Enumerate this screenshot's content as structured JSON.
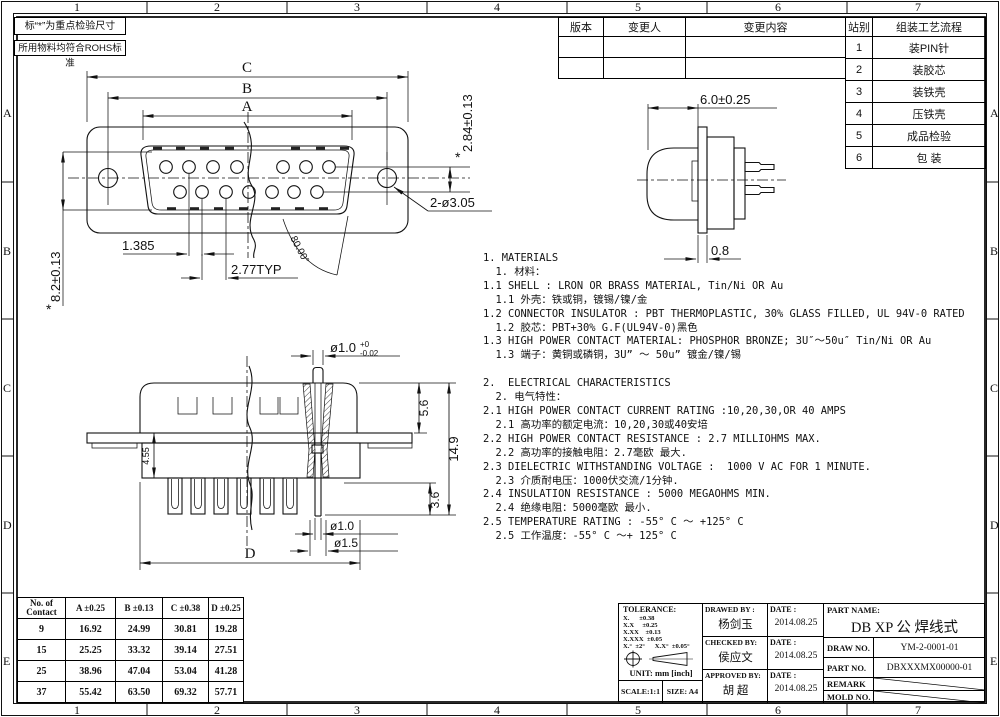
{
  "frame": {
    "cols": [
      "1",
      "2",
      "3",
      "4",
      "5",
      "6",
      "7"
    ],
    "rows": [
      "A",
      "B",
      "C",
      "D",
      "E"
    ]
  },
  "corner_notes": {
    "inspection": "标“*”为重点检验尺寸",
    "rohs": "所用物料均符合ROHS标准"
  },
  "revision_table": {
    "col_version": "版本",
    "col_author": "变更人",
    "col_content": "变更内容"
  },
  "process_table": {
    "col_station": "站别",
    "col_flow": "组装工艺流程",
    "rows": [
      {
        "no": "1",
        "step": "装PIN针"
      },
      {
        "no": "2",
        "step": "装胶芯"
      },
      {
        "no": "3",
        "step": "装铁壳"
      },
      {
        "no": "4",
        "step": "压铁壳"
      },
      {
        "no": "5",
        "step": "成品检验"
      },
      {
        "no": "6",
        "step": "包 装"
      }
    ]
  },
  "front_view": {
    "dim_c": "C",
    "dim_b": "B",
    "dim_a": "A",
    "dim_row": "2.84±0.13",
    "dim_height": "8.2±0.13",
    "star": "*",
    "dim_half_pitch": "1.385",
    "dim_pitch": "2.77TYP",
    "dim_holes": "2-ø3.05",
    "dim_angle": "80.00°"
  },
  "side_view": {
    "dim_depth": "6.0±0.25",
    "dim_flange": "0.8"
  },
  "section_view": {
    "dim_pin_dia": "ø1.0",
    "tol_plus": "+0",
    "tol_minus": "-0.02",
    "dim_shell": "5.6",
    "dim_total": "14.9",
    "dim_insulator": "4.55",
    "dim_tail": "3.6",
    "dim_tail_dia": "ø1.0",
    "dim_cup_dia": "ø1.5",
    "dim_d": "D"
  },
  "notes": {
    "lines": [
      "1. MATERIALS",
      "  1. 材料：",
      "1.1 SHELL : LRON OR BRASS MATERIAL, Tin/Ni OR Au",
      "  1.1 外壳：铁或铜，镀锡/镍/金",
      "1.2 CONNECTOR INSULATOR : PBT THERMOPLASTIC, 30% GLASS FILLED, UL 94V-0 RATED",
      "  1.2 胶芯：PBT+30% G.F(UL94V-0)黑色",
      "1.3 HIGH POWER CONTACT MATERIAL: PHOSPHOR BRONZE; 3U″～50u″ Tin/Ni OR Au",
      "  1.3 端子：黄铜或磷铜，3U” ～ 50u” 镀金/镍/锡",
      "",
      "2.  ELECTRICAL CHARACTERISTICS",
      "  2. 电气特性：",
      "2.1 HIGH POWER CONTACT CURRENT RATING :10,20,30,OR 40 AMPS",
      "  2.1 高功率的额定电流：10,20,30或40安培",
      "2.2 HIGH POWER CONTACT RESISTANCE : 2.7 MILLIOHMS MAX.",
      "  2.2 高功率的接触电阻：2.7毫欧 最大.",
      "2.3 DIELECTRIC WITHSTANDING VOLTAGE :  1000 V AC FOR 1 MINUTE.",
      "  2.3 介质耐电压：1000伏交流/1分钟.",
      "2.4 INSULATION RESISTANCE : 5000 MEGAOHMS MIN.",
      "  2.4 绝缘电阻：5000毫欧 最小.",
      "2.5 TEMPERATURE RATING : -55° C ～ +125° C",
      "  2.5 工作温度：-55° C ～+ 125° C"
    ]
  },
  "contact_table": {
    "h_contact_1": "No. of",
    "h_contact_2": "Contact",
    "h_a": "A ±0.25",
    "h_b": "B ±0.13",
    "h_c": "C ±0.38",
    "h_d": "D ±0.25",
    "rows": [
      [
        "9",
        "16.92",
        "24.99",
        "30.81",
        "19.28"
      ],
      [
        "15",
        "25.25",
        "33.32",
        "39.14",
        "27.51"
      ],
      [
        "25",
        "38.96",
        "47.04",
        "53.04",
        "41.28"
      ],
      [
        "37",
        "55.42",
        "63.50",
        "69.32",
        "57.71"
      ]
    ]
  },
  "title_block": {
    "tolerance_label": "TOLERANCE:",
    "tol_lines": [
      "X.      ±0.38",
      "X.X     ±0.25",
      "X.XX    ±0.13",
      "X.XXX  ±0.05",
      "X.°  ±2°      X.X°  ±0.05°"
    ],
    "unit": "UNIT: mm [inch]",
    "scale": "SCALE:1:1",
    "size": "SIZE: A4",
    "drawed_label": "DRAWED BY :",
    "drawed_name": "杨剑玉",
    "checked_label": "CHECKED BY:",
    "checked_name": "侯应文",
    "approved_label": "APPROVED BY:",
    "approved_name": "胡  超",
    "date_label": "DATE :",
    "date_drawed": "2014.08.25",
    "date_checked": "2014.08.25",
    "date_approved": "2014.08.25",
    "part_name_label": "PART NAME:",
    "part_name": "DB XP 公 焊线式",
    "draw_no_label": "DRAW NO.",
    "draw_no": "YM-2-0001-01",
    "part_no_label": "PART NO.",
    "part_no": "DBXXXMX00000-01",
    "remark_label": "REMARK",
    "mold_label": "MOLD NO."
  }
}
